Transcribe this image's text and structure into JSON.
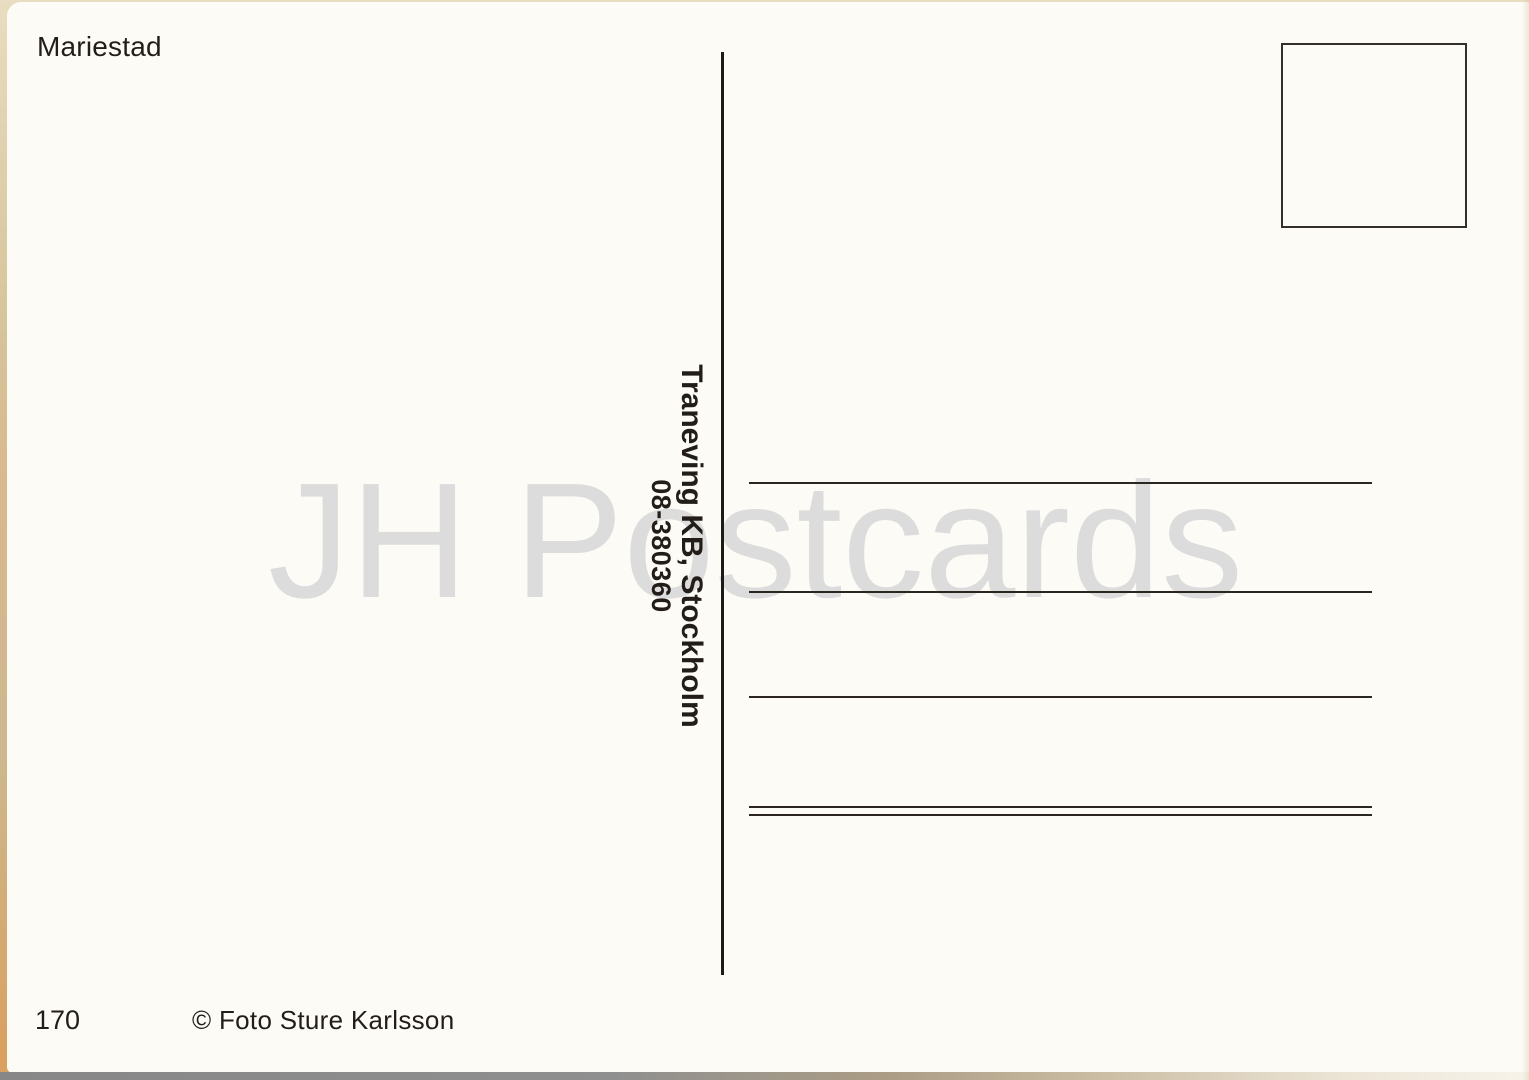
{
  "postcard": {
    "title": "Mariestad",
    "publisher": {
      "name": "Traneving KB, Stockholm",
      "phone": "08-380360"
    },
    "watermark": "JH Postcards",
    "card_number": "170",
    "copyright": "© Foto Sture Karlsson",
    "address_lines_count": 4
  },
  "colors": {
    "card_bg": "#fcfbf6",
    "ink": "#221d18",
    "line": "#2c2620",
    "watermark": "#dcdcdc",
    "scan_edge": "#cdbb92",
    "scan_strip": "#878787"
  }
}
